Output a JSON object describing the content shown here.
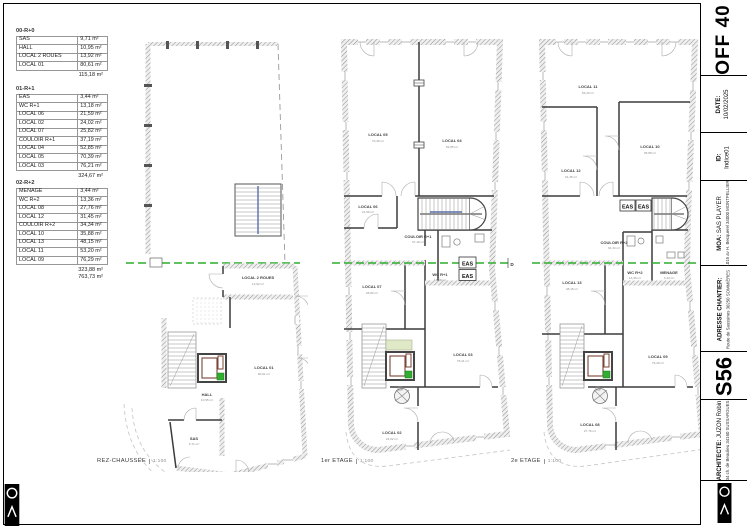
{
  "tables": [
    {
      "title": "00-R+0",
      "rows": [
        [
          "SAS",
          "9,71 m²"
        ],
        [
          "HALL",
          "10,95 m²"
        ],
        [
          "LOCAL 2 ROUES",
          "13,92 m²"
        ],
        [
          "LOCAL 01",
          "80,61 m²"
        ]
      ],
      "total": "115,18 m²"
    },
    {
      "title": "01-R+1",
      "rows": [
        [
          "EAS",
          "3,44 m²"
        ],
        [
          "WC R+1",
          "13,18 m²"
        ],
        [
          "LOCAL 06",
          "21,59 m²"
        ],
        [
          "LOCAL 02",
          "24,02 m²"
        ],
        [
          "LOCAL 07",
          "25,82 m²"
        ],
        [
          "COULOIR R+1",
          "37,19 m²"
        ],
        [
          "LOCAL 04",
          "52,85 m²"
        ],
        [
          "LOCAL 05",
          "70,39 m²"
        ],
        [
          "LOCAL 03",
          "76,21 m²"
        ]
      ],
      "total": "324,67 m²"
    },
    {
      "title": "02-R+2",
      "rows": [
        [
          "MENAGE",
          "3,44 m²"
        ],
        [
          "WC R+2",
          "13,36 m²"
        ],
        [
          "LOCAL 08",
          "27,76 m²"
        ],
        [
          "LOCAL 12",
          "31,45 m²"
        ],
        [
          "COULOIR R+2",
          "34,34 m²"
        ],
        [
          "LOCAL 10",
          "35,88 m²"
        ],
        [
          "LOCAL 13",
          "48,15 m²"
        ],
        [
          "LOCAL 11",
          "53,20 m²"
        ],
        [
          "LOCAL 09",
          "76,29 m²"
        ]
      ],
      "subtotal": "323,88 m²",
      "total": "763,73 m²"
    }
  ],
  "plans": [
    {
      "caption": "REZ-CHAUSSEE",
      "scale": "1:100",
      "rooms": [
        {
          "name": "LOCAL 2 ROUES",
          "area": "13,92 m²"
        },
        {
          "name": "LOCAL 01",
          "area": "80,61 m²"
        },
        {
          "name": "HALL",
          "area": "10,95 m²"
        },
        {
          "name": "SAS",
          "area": "9,71 m²"
        }
      ]
    },
    {
      "caption": "1er ETAGE",
      "scale": "1:100",
      "rooms": [
        {
          "name": "LOCAL 05",
          "area": "70,39 m²"
        },
        {
          "name": "LOCAL 04",
          "area": "52,85 m²"
        },
        {
          "name": "LOCAL 06",
          "area": "21,59 m²"
        },
        {
          "name": "COULOIR R+1",
          "area": "37,19 m²"
        },
        {
          "name": "WC R+1",
          "area": "13,18 m²"
        },
        {
          "name": "LOCAL 07",
          "area": "25,82 m²"
        },
        {
          "name": "LOCAL 03",
          "area": "76,21 m²"
        },
        {
          "name": "LOCAL 02",
          "area": "24,02 m²"
        },
        {
          "name": "EAS"
        },
        {
          "name": "EAS"
        }
      ]
    },
    {
      "caption": "2e ETAGE",
      "scale": "1:100",
      "rooms": [
        {
          "name": "LOCAL 11",
          "area": "53,20 m²"
        },
        {
          "name": "LOCAL 10",
          "area": "35,88 m²"
        },
        {
          "name": "LOCAL 12",
          "area": "31,45 m²"
        },
        {
          "name": "COULOIR R+2",
          "area": "34,34 m²"
        },
        {
          "name": "WC R+2",
          "area": "13,36 m²"
        },
        {
          "name": "MENAGE",
          "area": "3,44 m²"
        },
        {
          "name": "LOCAL 13",
          "area": "48,15 m²"
        },
        {
          "name": "LOCAL 09",
          "area": "76,29 m²"
        },
        {
          "name": "LOCAL 08",
          "area": "27,76 m²"
        },
        {
          "name": "EAS"
        },
        {
          "name": "EAS"
        }
      ]
    }
  ],
  "section_marker": "D",
  "titleblock": {
    "sheet_code": "OFF 40",
    "date_label": "DATE:",
    "date_value": "10/02/2025",
    "id_label": "ID:",
    "id_value": "Indice01",
    "moa_label": "MOA:",
    "moa_value": "SAS PLAYER",
    "moa_address": "1015 av H. Becquerel 34000 MONTPELLIER",
    "site_label": "ADRESSE CHANTIER:",
    "site_value": "Route de Saussines 30250 SOMMIÈRES",
    "project_code": "S56",
    "architect_label": "ARCHITECTE:",
    "architect_value": "JUZON Robin",
    "architect_address": "34 ch. de Beaulieu 34160 SUSSARGUES"
  },
  "colors": {
    "section_line": "#2fae2f",
    "elevator_marker": "#2fae2f",
    "landing_fill": "#dfe9c8",
    "accent_maroon": "#7a4435",
    "rail_blue": "#5b6ea8"
  }
}
